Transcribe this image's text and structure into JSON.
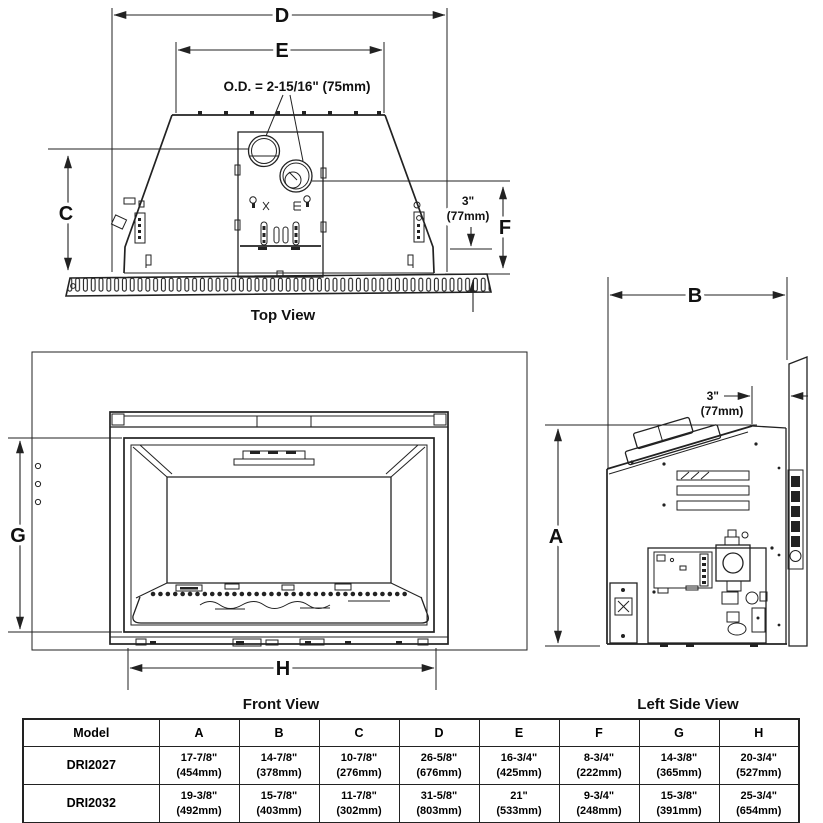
{
  "top_view": {
    "caption": "Top View",
    "dim_d": "D",
    "dim_e": "E",
    "dim_c": "C",
    "dim_f": "F",
    "od_label": "O.D. = 2-15/16\" (75mm)",
    "offset_in": "3\"",
    "offset_mm": "(77mm)"
  },
  "front_view": {
    "caption": "Front View",
    "dim_g": "G",
    "dim_h": "H"
  },
  "side_view": {
    "caption": "Left Side View",
    "dim_a": "A",
    "dim_b": "B",
    "offset_in": "3\"",
    "offset_mm": "(77mm)"
  },
  "table": {
    "headers": [
      "Model",
      "A",
      "B",
      "C",
      "D",
      "E",
      "F",
      "G",
      "H"
    ],
    "rows": [
      {
        "model": "DRI2027",
        "values": [
          [
            "17-7/8\"",
            "(454mm)"
          ],
          [
            "14-7/8\"",
            "(378mm)"
          ],
          [
            "10-7/8\"",
            "(276mm)"
          ],
          [
            "26-5/8\"",
            "(676mm)"
          ],
          [
            "16-3/4\"",
            "(425mm)"
          ],
          [
            "8-3/4\"",
            "(222mm)"
          ],
          [
            "14-3/8\"",
            "(365mm)"
          ],
          [
            "20-3/4\"",
            "(527mm)"
          ]
        ]
      },
      {
        "model": "DRI2032",
        "values": [
          [
            "19-3/8\"",
            "(492mm)"
          ],
          [
            "15-7/8\"",
            "(403mm)"
          ],
          [
            "11-7/8\"",
            "(302mm)"
          ],
          [
            "31-5/8\"",
            "(803mm)"
          ],
          [
            "21\"",
            "(533mm)"
          ],
          [
            "9-3/4\"",
            "(248mm)"
          ],
          [
            "15-3/8\"",
            "(391mm)"
          ],
          [
            "25-3/4\"",
            "(654mm)"
          ]
        ]
      }
    ]
  },
  "colors": {
    "line": "#222222",
    "background": "#ffffff",
    "text": "#111111"
  }
}
